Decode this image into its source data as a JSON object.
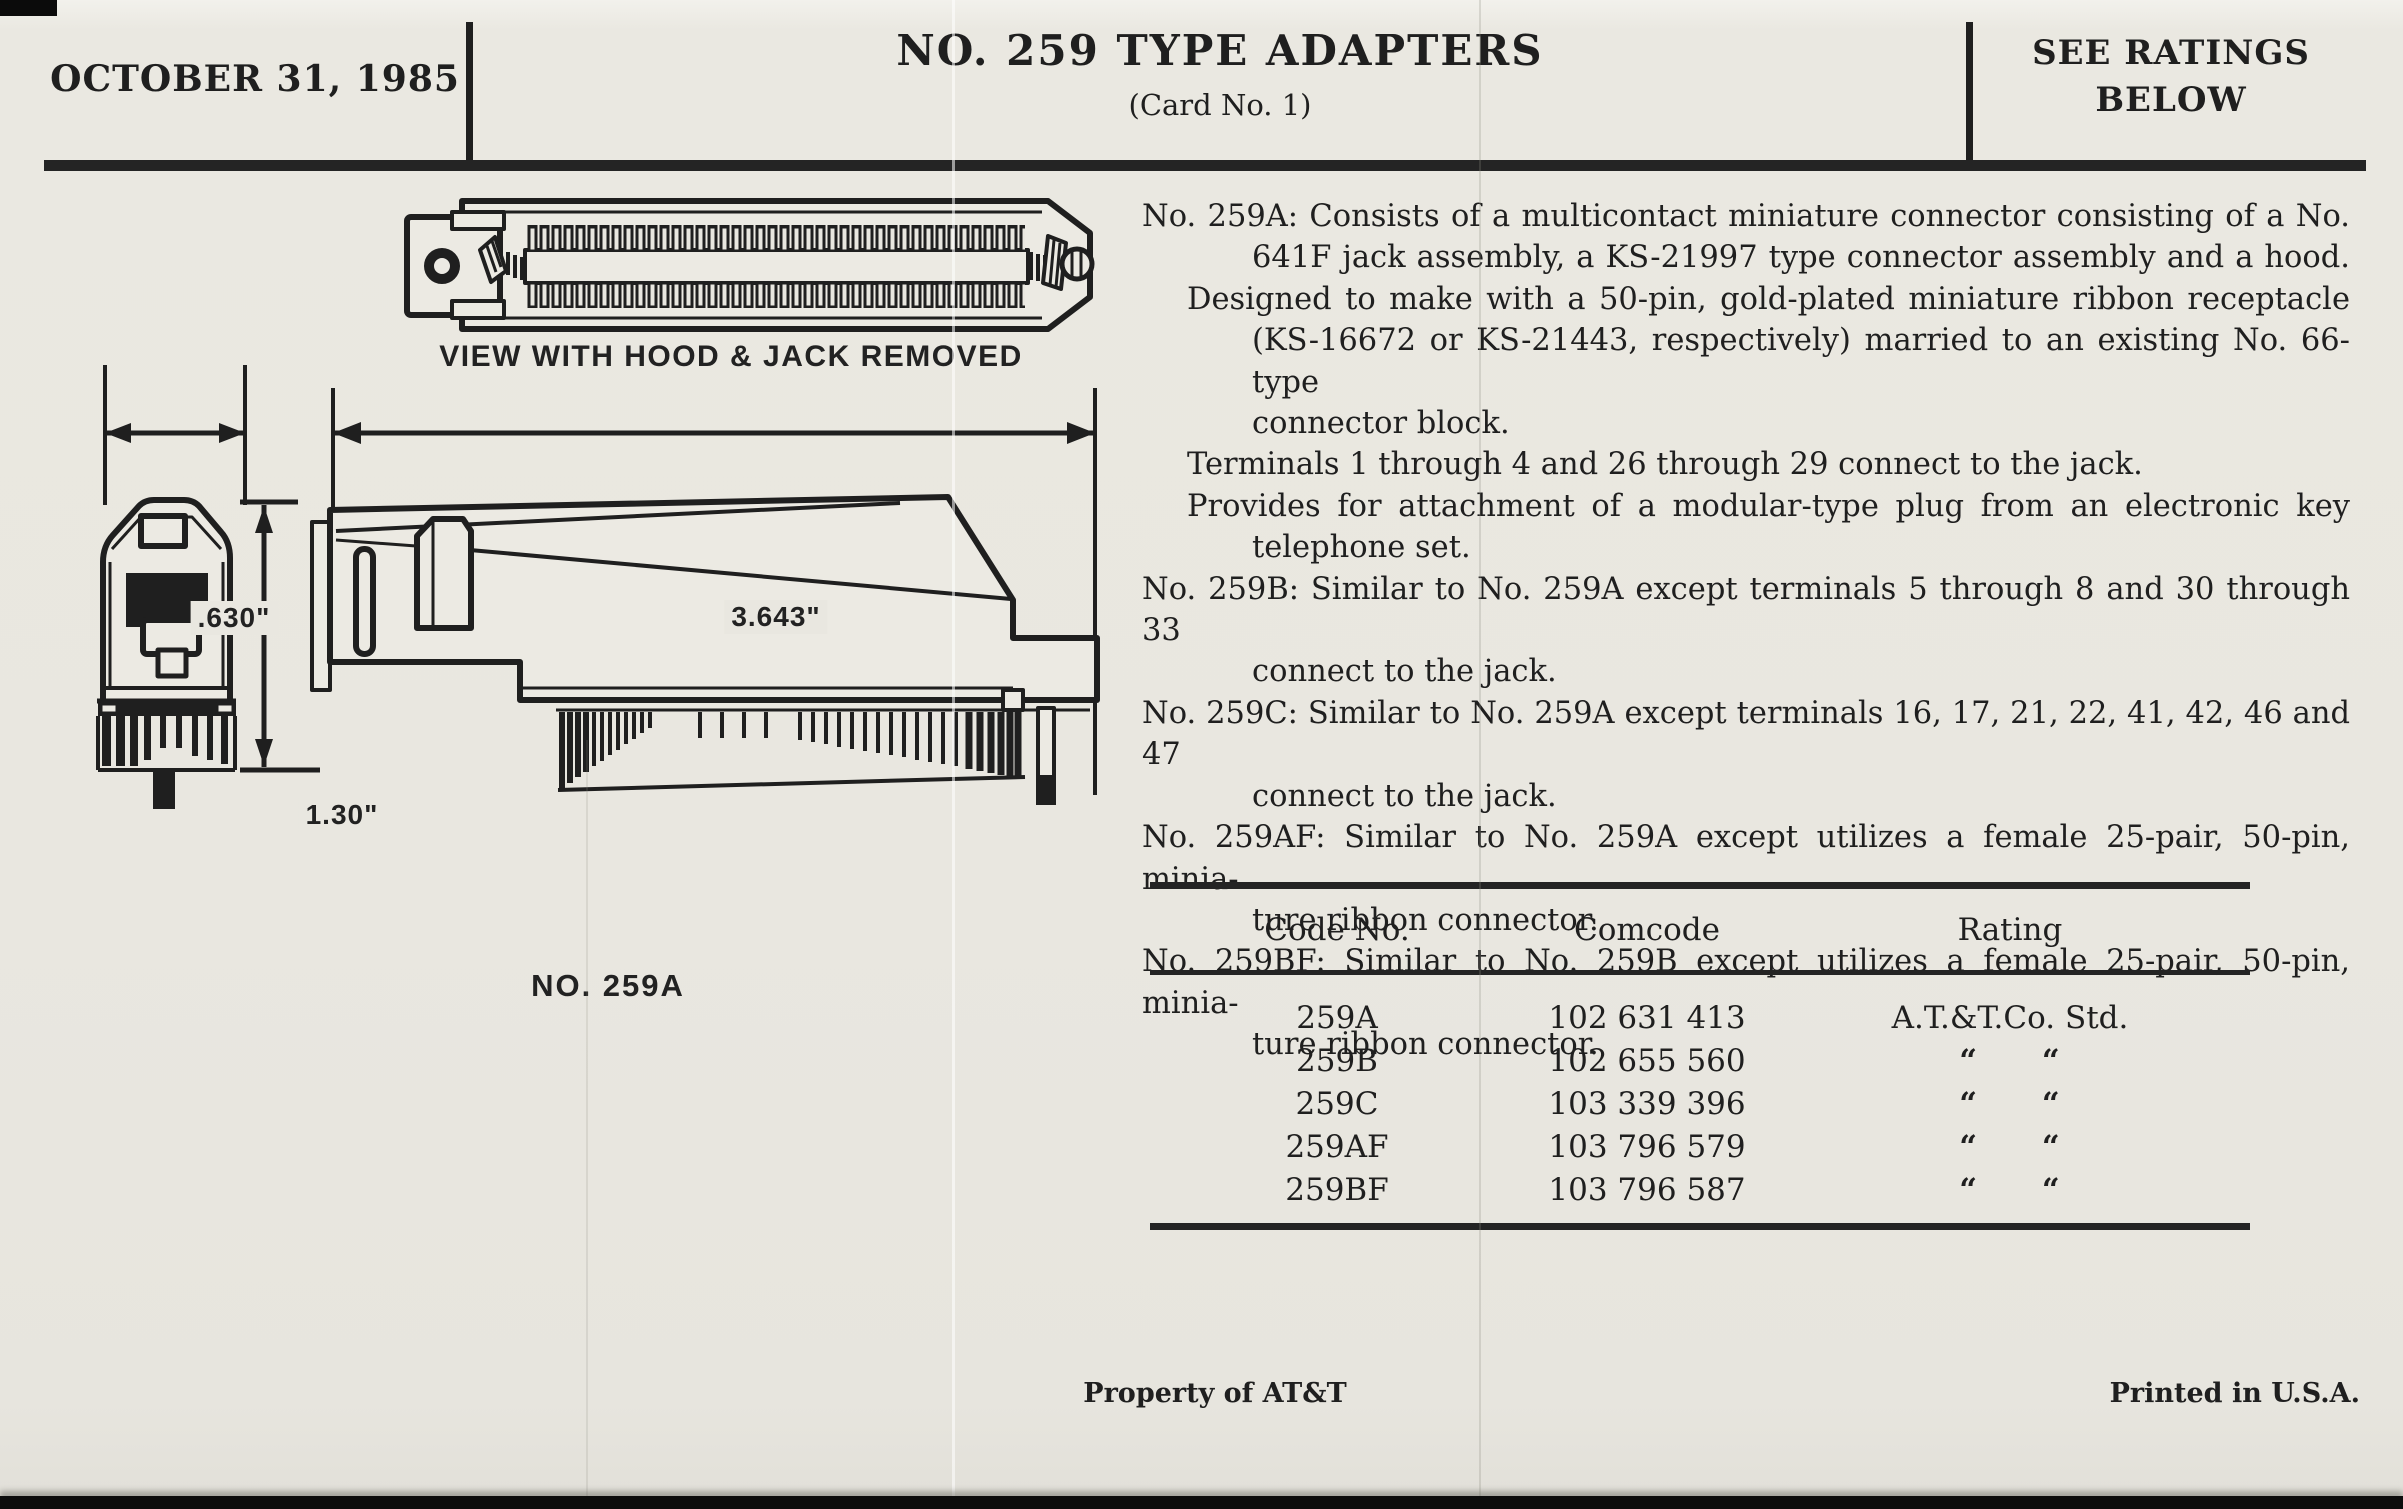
{
  "header": {
    "date": "OCTOBER 31, 1985",
    "title": "NO. 259 TYPE ADAPTERS",
    "subtitle": "(Card No. 1)",
    "ratings_note": "SEE RATINGS BELOW"
  },
  "diagram": {
    "view_caption": "VIEW WITH HOOD & JACK REMOVED",
    "dim_width_small": ".630\"",
    "dim_width_large": "3.643\"",
    "dim_height": "1.30\"",
    "part_label": "NO. 259A"
  },
  "description": {
    "lines": [
      "No. 259A: Consists of a multicontact miniature connector consisting of a No.",
      "641F jack assembly, a KS-21997 type connector assembly and a hood.",
      "Designed to make with a 50-pin, gold-plated miniature ribbon receptacle",
      "(KS-16672 or KS-21443, respectively) married to an existing No. 66-type",
      "connector block.",
      "Terminals 1 through 4 and 26 through 29 connect to the jack.",
      "Provides for attachment of a modular-type plug from an electronic key",
      "telephone set.",
      "No. 259B: Similar to No. 259A except terminals 5 through 8 and 30 through 33",
      "connect to the jack.",
      "No. 259C: Similar to No. 259A except terminals 16, 17, 21, 22, 41, 42, 46 and 47",
      "connect to the jack.",
      "No. 259AF: Similar to No. 259A except utilizes a female 25-pair, 50-pin, minia-",
      "ture ribbon connector.",
      "No. 259BF: Similar to No. 259B except utilizes a female 25-pair, 50-pin, minia-",
      "ture ribbon connector."
    ]
  },
  "table": {
    "headers": [
      "Code No.",
      "Comcode",
      "Rating"
    ],
    "rows": [
      {
        "code": "259A",
        "comcode": "102 631 413",
        "rating": "A.T.&T.Co. Std."
      },
      {
        "code": "259B",
        "comcode": "102 655 560",
        "rating": "“ “"
      },
      {
        "code": "259C",
        "comcode": "103 339 396",
        "rating": "“ “"
      },
      {
        "code": "259AF",
        "comcode": "103 796 579",
        "rating": "“ “"
      },
      {
        "code": "259BF",
        "comcode": "103 796 587",
        "rating": "“ “"
      }
    ]
  },
  "footer": {
    "left": "Property of AT&T",
    "right": "Printed in U.S.A."
  },
  "colors": {
    "paper": "#e9e7e0",
    "ink": "#1f1f1f"
  }
}
